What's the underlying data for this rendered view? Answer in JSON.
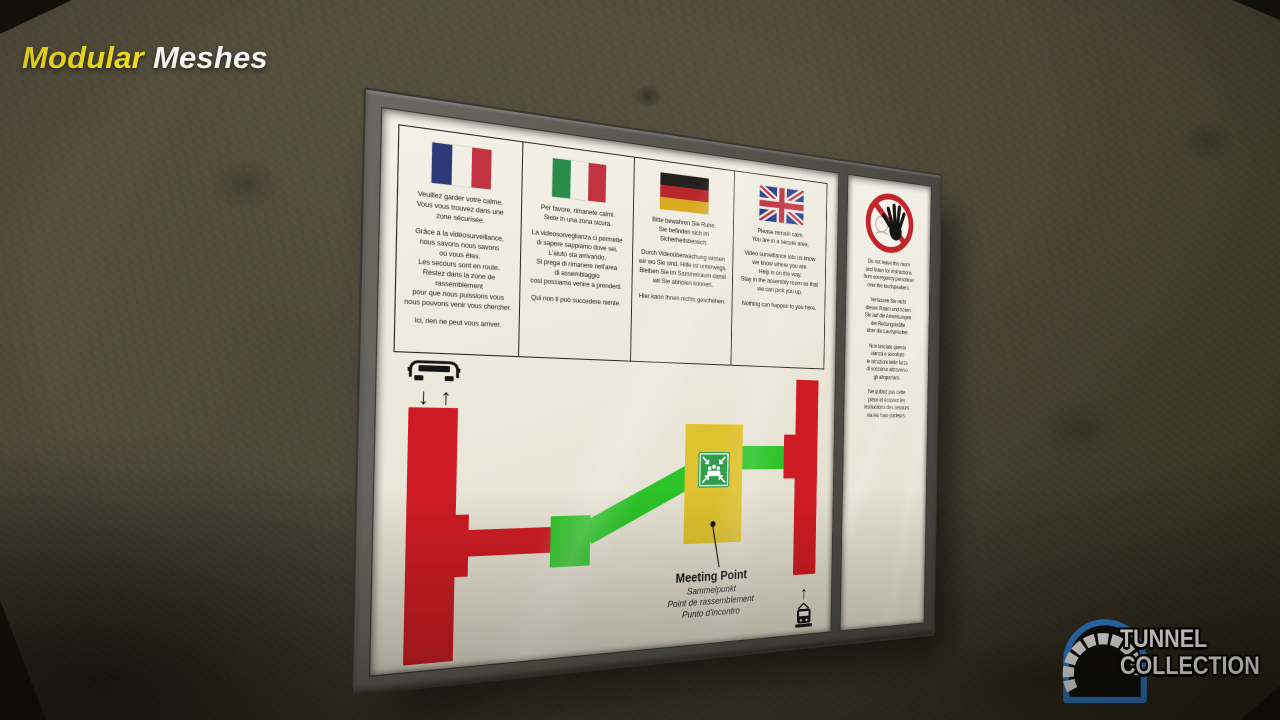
{
  "watermark": {
    "word_yellow": "Modular",
    "word_white": "Meshes"
  },
  "brand_badge": {
    "line1": "TUNNEL",
    "line2": "COLLECTION",
    "arch_outline_color": "#2d7ed2"
  },
  "notice_board": {
    "language_panels": [
      {
        "language": "French",
        "flag": "france",
        "para1": "Veuillez garder votre calme.\nVous vous trouvez dans une\nzone sécurisée.",
        "para2": "Grâce à la vidéosurveillance,\nnous savons nous savons\noù vous êtes.\nLes secours sont en route.\nRestez dans la zone de rassemblement\npour que nous puissions vous\nnous pouvons venir vous chercher.",
        "para3": "Ici, rien ne peut vous arriver."
      },
      {
        "language": "Italian",
        "flag": "italy",
        "para1": "Per favore, rimanete calmi.\nSiete in una zona sicura.",
        "para2": "La videosorveglianza ci permette\ndi sapere sappiamo dove sei.\nL'aiuto sta arrivando.\nSi prega di rimanere nell'area\ndi assemblaggio\ncosì possiamo venire a prenderti.",
        "para3": "Qui non ti può succedere niente."
      },
      {
        "language": "German",
        "flag": "germany",
        "para1": "Bitte bewahren Sie Ruhe.\nSie befinden sich im Sicherheitsbereich.",
        "para2": "Durch Videoüberwachung wissen\nwir wo Sie sind. Hilfe ist unterwegs.\nBleiben Sie im Sammelraum damit\nwir Sie abholen können.",
        "para3": "Hier kann Ihnen nichts geschehen."
      },
      {
        "language": "English",
        "flag": "uk",
        "para1": "Please remain calm.\nYou are in a secure area.",
        "para2": "Video surveillance lets us know\nwe know where you are.\nHelp is on the way.\nStay in the assembly room so that\nwe can pick you up.",
        "para3": "Nothing can happen to you here."
      }
    ],
    "instruction_panel": {
      "para_en": "Do not leave this room\nand listen for instructions\nfrom emergency personnel\nover the loudspeakers.",
      "para_de": "Verlassen Sie nicht\ndiesen Raum und hören\nSie auf die Anweisungen\nder Rettungskräfte\nüber die Lautsprecher.",
      "para_it": "Non lasciate questa\nstanza e ascoltate\nle istruzioni delle forze\ndi soccorso attraverso\ngli altoparlanti.",
      "para_fr": "Ne quittez pas cette\npièce et écoutez les\ninstructions des secours\nvia les haut-parleurs."
    },
    "evacuation_map": {
      "meeting_point_title": "Meeting Point",
      "meeting_point_de": "Sammelpunkt",
      "meeting_point_fr": "Point de rassemblement",
      "meeting_point_it": "Punto d'incontro",
      "arrow_down": "↓",
      "arrow_up": "↑",
      "colors": {
        "route_red": "#cf1c24",
        "route_green": "#2cc428",
        "meeting_yellow": "#dfc22f",
        "assembly_green": "#2f9d4b"
      }
    }
  }
}
